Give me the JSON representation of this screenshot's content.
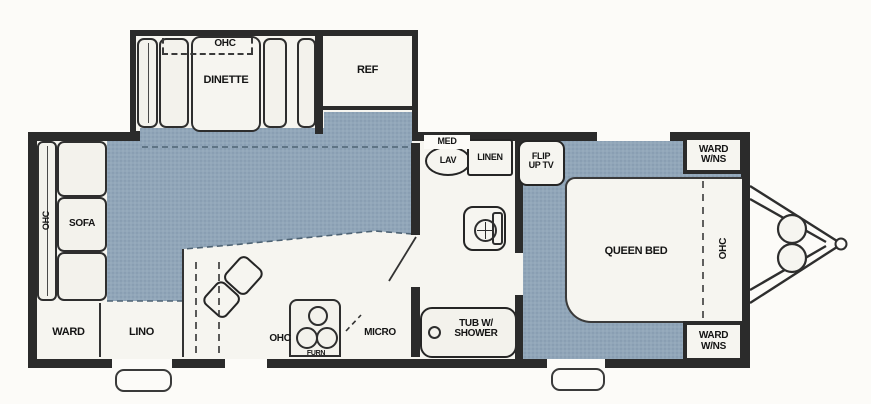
{
  "title": "travel-trailer-floor-plan",
  "colors": {
    "carpet": "#91a6b9",
    "carpet_dot": "#7e94a9",
    "wall": "#2b2b2b",
    "floor": "#f6f5f0",
    "paper": "#fcfbf8"
  },
  "fp": {
    "slideout": {
      "ohc": "OHC",
      "dinette": "DINETTE",
      "ref": "REF"
    },
    "rear": {
      "ohc": "OHC",
      "sofa": "SOFA",
      "ward": "WARD",
      "lino": "LINO"
    },
    "kitchen": {
      "ohc": "OHC",
      "furn": "FURN",
      "micro": "MICRO"
    },
    "bath": {
      "med": "MED",
      "lav": "LAV",
      "linen": "LINEN",
      "tub1": "TUB W/",
      "tub2": "SHOWER"
    },
    "bed": {
      "tv1": "FLIP",
      "tv2": "UP TV",
      "queen": "QUEEN BED",
      "ohc_foot": "OHC",
      "ward_ns_l1": "WARD",
      "ward_ns_l2": "W/NS"
    }
  }
}
